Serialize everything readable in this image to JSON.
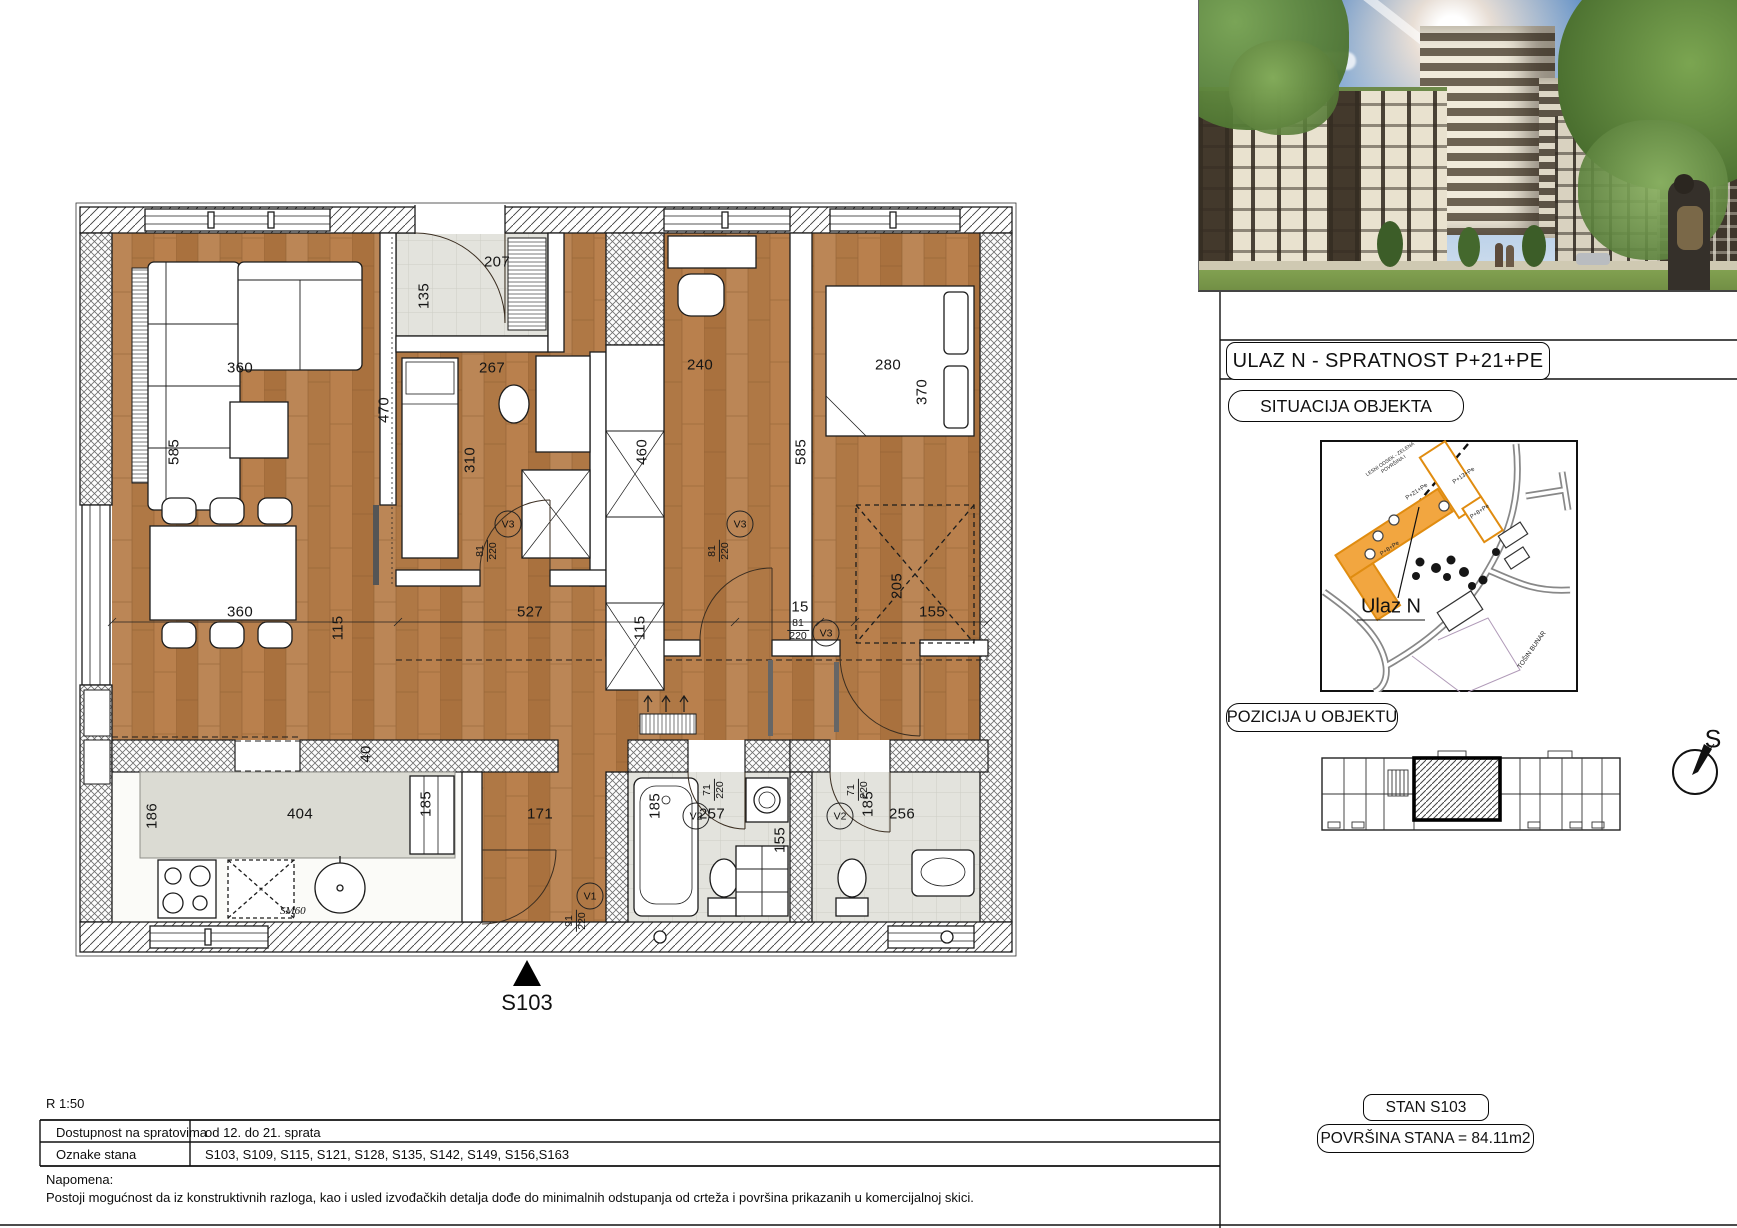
{
  "colors": {
    "wood": "#b27b49",
    "tile": "#e3e3dd",
    "accent_orange": "#f2a640",
    "orange_stroke": "#e08c10",
    "wall_ink": "#1c1c1c"
  },
  "panel": {
    "title": "ULAZ N - SPRATNOST P+21+PE",
    "situacija_label": "SITUACIJA OBJEKTA",
    "pozicija_label": "POZICIJA U OBJEKTU",
    "ulaz_pointer_label": "Ulaz N",
    "stan_label": "STAN S103",
    "povrsina_label": "POVRŠINA STANA = 84.11m2",
    "compass_letter": "S"
  },
  "map_labels": [
    {
      "t": "LESNI ODSEK - ZELENA POVRŠINA I",
      "x": 1392,
      "y": 462,
      "r": -34,
      "fs": 5,
      "w": 84
    },
    {
      "t": "P+21+Pe",
      "x": 1417,
      "y": 492,
      "r": -34,
      "fs": 6
    },
    {
      "t": "P+13+Pe",
      "x": 1464,
      "y": 476,
      "r": -34,
      "fs": 6
    },
    {
      "t": "P+8+Pe",
      "x": 1390,
      "y": 549,
      "r": -34,
      "fs": 6
    },
    {
      "t": "P+8+Pe",
      "x": 1480,
      "y": 512,
      "r": -34,
      "fs": 6
    },
    {
      "t": "TOŠIN BUNAR",
      "x": 1532,
      "y": 650,
      "r": -55,
      "fs": 6.5
    }
  ],
  "plan": {
    "scale": "R 1:50",
    "unit_marker": "S103",
    "appliance_label": "SM60",
    "dims": [
      {
        "t": "207",
        "x": 497,
        "y": 262
      },
      {
        "t": "135",
        "x": 424,
        "y": 296,
        "v": 1
      },
      {
        "t": "360",
        "x": 240,
        "y": 368
      },
      {
        "t": "267",
        "x": 492,
        "y": 368
      },
      {
        "t": "240",
        "x": 700,
        "y": 365
      },
      {
        "t": "280",
        "x": 888,
        "y": 365
      },
      {
        "t": "370",
        "x": 922,
        "y": 392,
        "v": 1
      },
      {
        "t": "470",
        "x": 384,
        "y": 410,
        "v": 1
      },
      {
        "t": "585",
        "x": 174,
        "y": 452,
        "v": 1
      },
      {
        "t": "310",
        "x": 470,
        "y": 460,
        "v": 1
      },
      {
        "t": "460",
        "x": 642,
        "y": 452,
        "v": 1
      },
      {
        "t": "585",
        "x": 801,
        "y": 452,
        "v": 1
      },
      {
        "t": "360",
        "x": 240,
        "y": 612
      },
      {
        "t": "527",
        "x": 530,
        "y": 612
      },
      {
        "t": "15",
        "x": 800,
        "y": 607
      },
      {
        "t": "155",
        "x": 932,
        "y": 612
      },
      {
        "t": "205",
        "x": 897,
        "y": 586,
        "v": 1
      },
      {
        "t": "115",
        "x": 338,
        "y": 628,
        "v": 1
      },
      {
        "t": "115",
        "x": 640,
        "y": 628,
        "v": 1
      },
      {
        "t": "40",
        "x": 366,
        "y": 754,
        "v": 1
      },
      {
        "t": "404",
        "x": 300,
        "y": 814
      },
      {
        "t": "186",
        "x": 152,
        "y": 816,
        "v": 1
      },
      {
        "t": "185",
        "x": 426,
        "y": 804,
        "v": 1
      },
      {
        "t": "171",
        "x": 540,
        "y": 814
      },
      {
        "t": "257",
        "x": 712,
        "y": 814
      },
      {
        "t": "185",
        "x": 655,
        "y": 806,
        "v": 1
      },
      {
        "t": "155",
        "x": 780,
        "y": 840,
        "v": 1
      },
      {
        "t": "256",
        "x": 902,
        "y": 814
      },
      {
        "t": "185",
        "x": 868,
        "y": 804,
        "v": 1
      }
    ],
    "doors": [
      {
        "id": "V1",
        "size": "91/220",
        "cx": 590,
        "cy": 896,
        "fx": 576,
        "fy": 921,
        "fv": 1
      },
      {
        "id": "V2",
        "size": "71/220",
        "cx": 696,
        "cy": 816,
        "fx": 714,
        "fy": 790,
        "fv": 1
      },
      {
        "id": "V2",
        "size": "71/220",
        "cx": 840,
        "cy": 816,
        "fx": 858,
        "fy": 790,
        "fv": 1
      },
      {
        "id": "V3",
        "size": "81/220",
        "cx": 508,
        "cy": 524,
        "fx": 487,
        "fy": 551,
        "fv": 1
      },
      {
        "id": "V3",
        "size": "81/220",
        "cx": 740,
        "cy": 524,
        "fx": 719,
        "fy": 551,
        "fv": 1
      },
      {
        "id": "V3",
        "size": "81/220",
        "cx": 826,
        "cy": 633,
        "fx": 798,
        "fy": 630,
        "fv": 0
      }
    ]
  },
  "footer": {
    "rows": [
      {
        "label": "Dostupnost na spratovima",
        "value": "od 12. do 21. sprata"
      },
      {
        "label": "Oznake stana",
        "value": "S103, S109, S115, S121, S128, S135, S142, S149, S156,S163"
      }
    ],
    "note_title": "Napomena:",
    "note_text": "Postoji mogućnost da iz konstruktivnih razloga, kao i usled izvođačkih detalja dođe do minimalnih odstupanja od crteža i površina prikazanih u komercijalnoj skici."
  }
}
